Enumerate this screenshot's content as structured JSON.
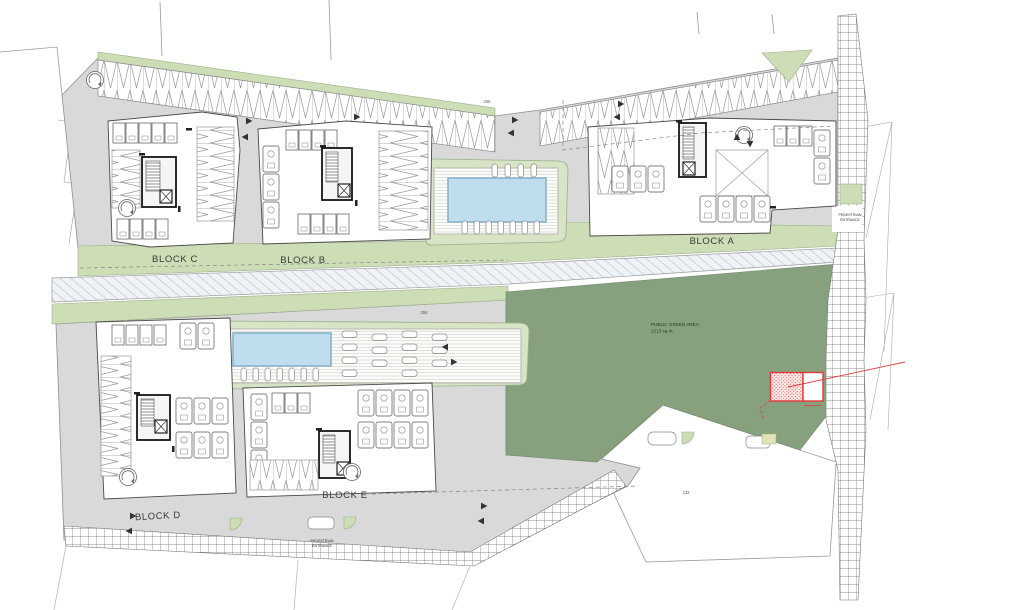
{
  "plan": {
    "blocks": [
      {
        "id": "a",
        "label": "BLOCK A"
      },
      {
        "id": "b",
        "label": "BLOCK B"
      },
      {
        "id": "c",
        "label": "BLOCK C"
      },
      {
        "id": "d",
        "label": "BLOCK D"
      },
      {
        "id": "e",
        "label": "BLOCK E"
      }
    ],
    "public_green_area": {
      "line1": "PUBLIC GREEN AREA:",
      "line2": "1213 sq.m."
    },
    "pedestrian_entrance": {
      "line1": "PEDESTRIAN",
      "line2": "ENTRANCE"
    },
    "refs": {
      "north_drive": "256",
      "central_path": "258",
      "south_parcel": "232"
    },
    "colors": {
      "building_slab": "#d9d9d9",
      "light_green": "#cdddb6",
      "pool_surround": "#d8e4c6",
      "public_green": "#87a17e",
      "pool_water": "#bedded",
      "highlight_red": "#e23b3b",
      "hatch_line": "#666666",
      "drawing_line": "#555555"
    }
  }
}
